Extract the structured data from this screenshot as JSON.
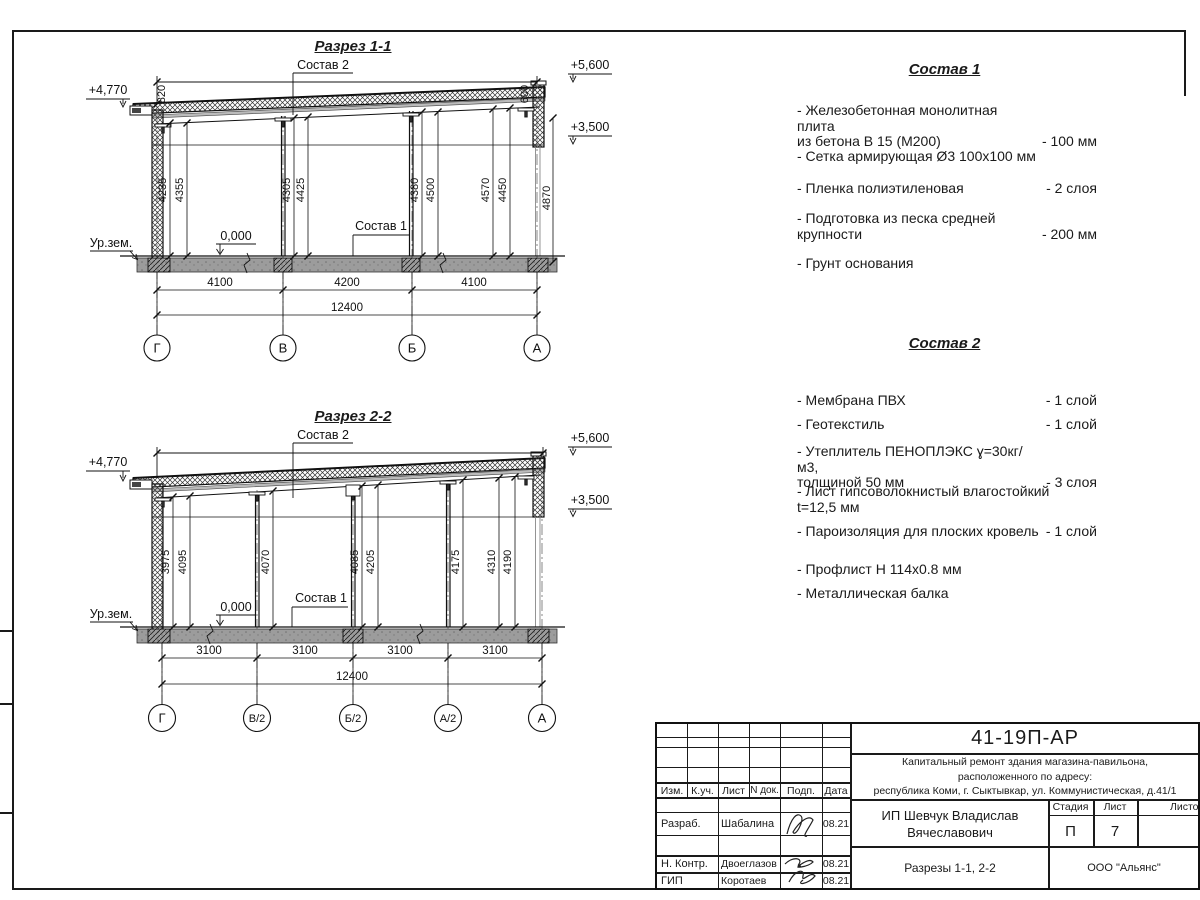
{
  "section1": {
    "title": "Разрез 1-1",
    "labels": {
      "sostav2": "Состав 2",
      "sostav1": "Состав 1",
      "zero": "0,000",
      "ground": "Ур.зем."
    },
    "elevations": {
      "left": "+4,770",
      "top_right": "+5,600",
      "mid_right": "+3,500"
    },
    "parapet_left": "820",
    "parapet_right": "600",
    "vdims": [
      "4235",
      "4355",
      "4305",
      "4425",
      "4380",
      "4500",
      "4570",
      "4450",
      "4870"
    ],
    "spans": [
      "4100",
      "4200",
      "4100"
    ],
    "total": "12400",
    "axes": [
      "Г",
      "В",
      "Б",
      "А"
    ]
  },
  "section2": {
    "title": "Разрез 2-2",
    "labels": {
      "sostav2": "Состав 2",
      "sostav1": "Состав 1",
      "zero": "0,000",
      "ground": "Ур.зем."
    },
    "elevations": {
      "left": "+4,770",
      "top_right": "+5,600",
      "mid_right": "+3,500"
    },
    "vdims": [
      "3975",
      "4095",
      "4070",
      "4085",
      "4205",
      "4175",
      "4310",
      "4190"
    ],
    "spans": [
      "3100",
      "3100",
      "3100",
      "3100"
    ],
    "total": "12400",
    "axes": [
      "Г",
      "В/2",
      "Б/2",
      "А/2",
      "А"
    ]
  },
  "sostav1": {
    "title": "Состав 1",
    "items": [
      {
        "text": "- Железобетонная  монолитная плита\nиз бетона В 15 (М200)",
        "value": "- 100 мм"
      },
      {
        "text": "- Сетка армирующая Ø3 100х100 мм",
        "value": ""
      },
      {
        "text": "- Пленка полиэтиленовая",
        "value": "- 2 слоя"
      },
      {
        "text": "- Подготовка из песка средней\nкрупности",
        "value": "- 200 мм"
      },
      {
        "text": "- Грунт основания",
        "value": ""
      }
    ]
  },
  "sostav2": {
    "title": "Состав 2",
    "items": [
      {
        "text": "- Мембрана ПВХ",
        "value": "- 1 слой"
      },
      {
        "text": "- Геотекстиль",
        "value": "- 1 слой"
      },
      {
        "text": "- Утеплитель ПЕНОПЛЭКС ɣ=30кг/м3,\nтолщиной 50 мм",
        "value": "- 3 слоя"
      },
      {
        "text": "- Лист гипсоволокнистый влагостойкий\nt=12,5 мм",
        "value": ""
      },
      {
        "text": "- Пароизоляция для плоских кровель",
        "value": "- 1 слой"
      },
      {
        "text": "- Профлист Н 114х0.8 мм",
        "value": ""
      },
      {
        "text": "- Металлическая балка",
        "value": ""
      }
    ]
  },
  "titleblock": {
    "doc_number": "41-19П-АР",
    "project": "Капитальный ремонт здания магазина-павильона,\nрасположенного по адресу:\nреспублика Коми, г. Сыктывкар, ул. Коммунистическая, д.41/1",
    "client": "ИП Шевчук Владислав\nВячеславович",
    "sheet_title": "Разрезы 1-1, 2-2",
    "organization": "ООО \"Альянс\"",
    "stage_label": "Стадия",
    "sheet_label": "Лист",
    "sheets_label": "Листов",
    "stage": "П",
    "sheet": "7",
    "cols": {
      "izm": "Изм.",
      "kuch": "К.уч.",
      "list": "Лист",
      "ndok": "N док.",
      "podp": "Подп.",
      "data": "Дата"
    },
    "rows": [
      {
        "role": "Разраб.",
        "name": "Шабалина",
        "date": "08.21"
      },
      {
        "role": "Н. Контр.",
        "name": "Двоеглазов",
        "date": "08.21"
      },
      {
        "role": "ГИП",
        "name": "Коротаев",
        "date": "08.21"
      }
    ]
  }
}
